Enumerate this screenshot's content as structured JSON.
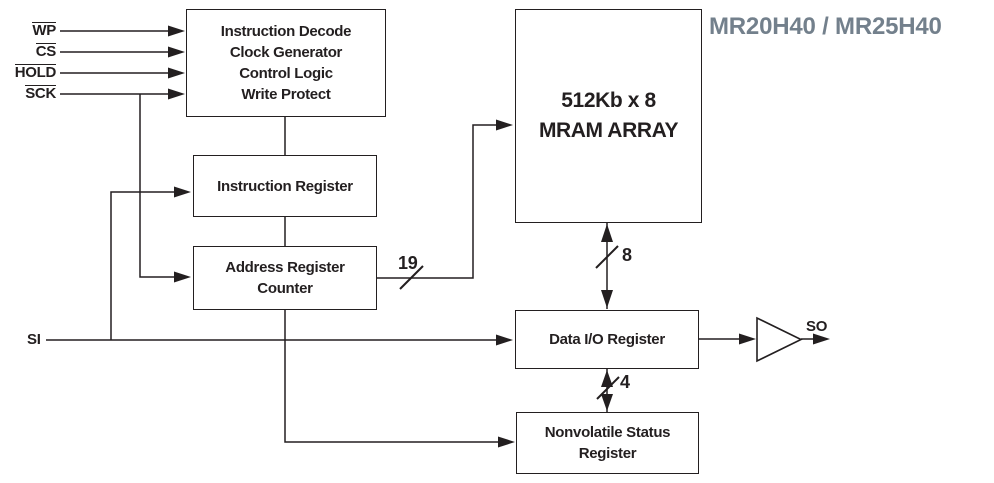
{
  "title": {
    "text": "MR20H40 / MR25H40",
    "color": "#73808C"
  },
  "colors": {
    "line": "#231F20",
    "block_border": "#231F20",
    "background": "#FFFFFF"
  },
  "signals": {
    "inputs": [
      {
        "label": "WP",
        "overline": true
      },
      {
        "label": "CS",
        "overline": true
      },
      {
        "label": "HOLD",
        "overline": true
      },
      {
        "label": "SCK",
        "overline": true
      },
      {
        "label": "SI",
        "overline": false
      }
    ],
    "output": {
      "label": "SO"
    }
  },
  "blocks": {
    "control_logic": {
      "lines": [
        "Instruction Decode",
        "Clock Generator",
        "Control Logic",
        "Write Protect"
      ]
    },
    "instruction_register": {
      "lines": [
        "Instruction Register"
      ]
    },
    "address_register_counter": {
      "lines": [
        "Address Register",
        "Counter"
      ]
    },
    "mram_array": {
      "lines": [
        "512Kb x 8",
        "MRAM ARRAY"
      ]
    },
    "data_io_register": {
      "lines": [
        "Data I/O Register"
      ]
    },
    "nonvolatile_status_register": {
      "lines": [
        "Nonvolatile Status",
        "Register"
      ]
    }
  },
  "bus_widths": {
    "address_bus": "19",
    "mram_data_bus": "8",
    "status_bus": "4"
  }
}
